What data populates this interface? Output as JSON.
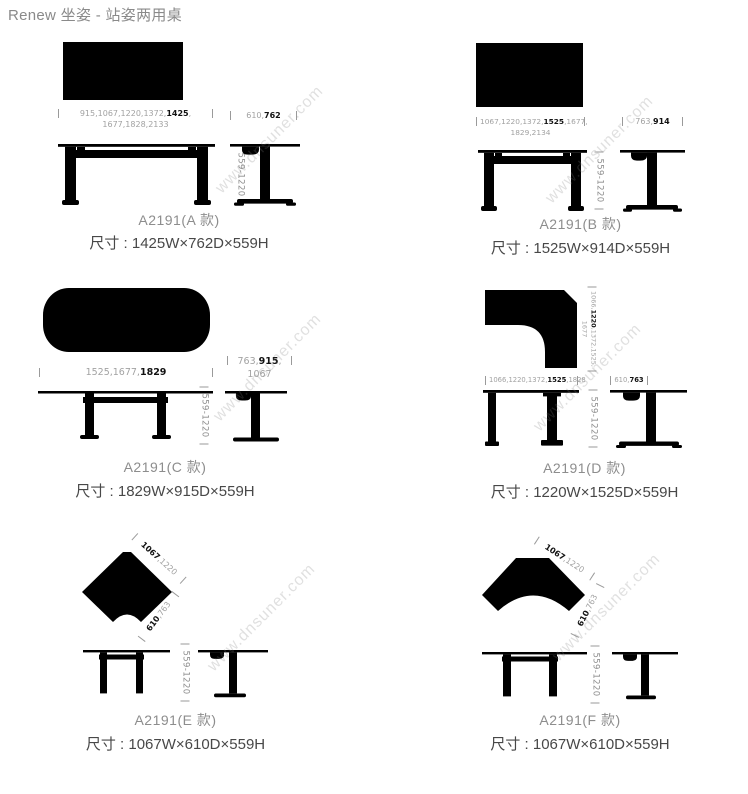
{
  "page": {
    "title": "Renew 坐姿 - 站姿两用桌"
  },
  "watermark": "www.dnsuner.com",
  "common": {
    "height_range": "559-1220"
  },
  "panels": {
    "a": {
      "width_dim": {
        "pre": "915,1067,1220,1372,",
        "bold": "1425",
        "post": ",",
        "line2": "1677,1828,2133"
      },
      "depth_dim": {
        "pre": "610,",
        "bold": "762",
        "post": ""
      },
      "label": "A2191(A 款)",
      "size": "尺寸 : 1425W×762D×559H"
    },
    "b": {
      "width_dim": {
        "pre": "1067,1220,1372,",
        "bold": "1525",
        "post": ",1677,",
        "line2": "1829,2134"
      },
      "depth_dim": {
        "pre": "763,",
        "bold": "914",
        "post": ""
      },
      "label": "A2191(B 款)",
      "size": "尺寸 : 1525W×914D×559H"
    },
    "c": {
      "width_dim": {
        "pre": "1525,1677,",
        "bold": "1829",
        "post": ""
      },
      "depth_dim": {
        "pre": "763,",
        "bold": "915",
        "post": ",",
        "line2": "1067"
      },
      "label": "A2191(C 款)",
      "size": "尺寸 : 1829W×915D×559H"
    },
    "d": {
      "side_dim": {
        "pre": "1066,",
        "bold": "1220",
        "post": ",1372,1525,",
        "line2": "1677"
      },
      "width_dim": {
        "pre": "1066,1220,1372,",
        "bold": "1525",
        "post": ",1828"
      },
      "depth_dim": {
        "pre": "610,",
        "bold": "763",
        "post": ""
      },
      "label": "A2191(D 款)",
      "size": "尺寸 : 1220W×1525D×559H"
    },
    "e": {
      "edge_dim1": {
        "bold": "1067",
        "post": ",1220"
      },
      "edge_dim2": {
        "bold": "610",
        "post": ",763"
      },
      "label": "A2191(E 款)",
      "size": "尺寸 : 1067W×610D×559H"
    },
    "f": {
      "edge_dim1": {
        "bold": "1067",
        "post": ",1220"
      },
      "edge_dim2": {
        "bold": "610",
        "post": ",763"
      },
      "label": "A2191(F 款)",
      "size": "尺寸 : 1067W×610D×559H"
    }
  }
}
